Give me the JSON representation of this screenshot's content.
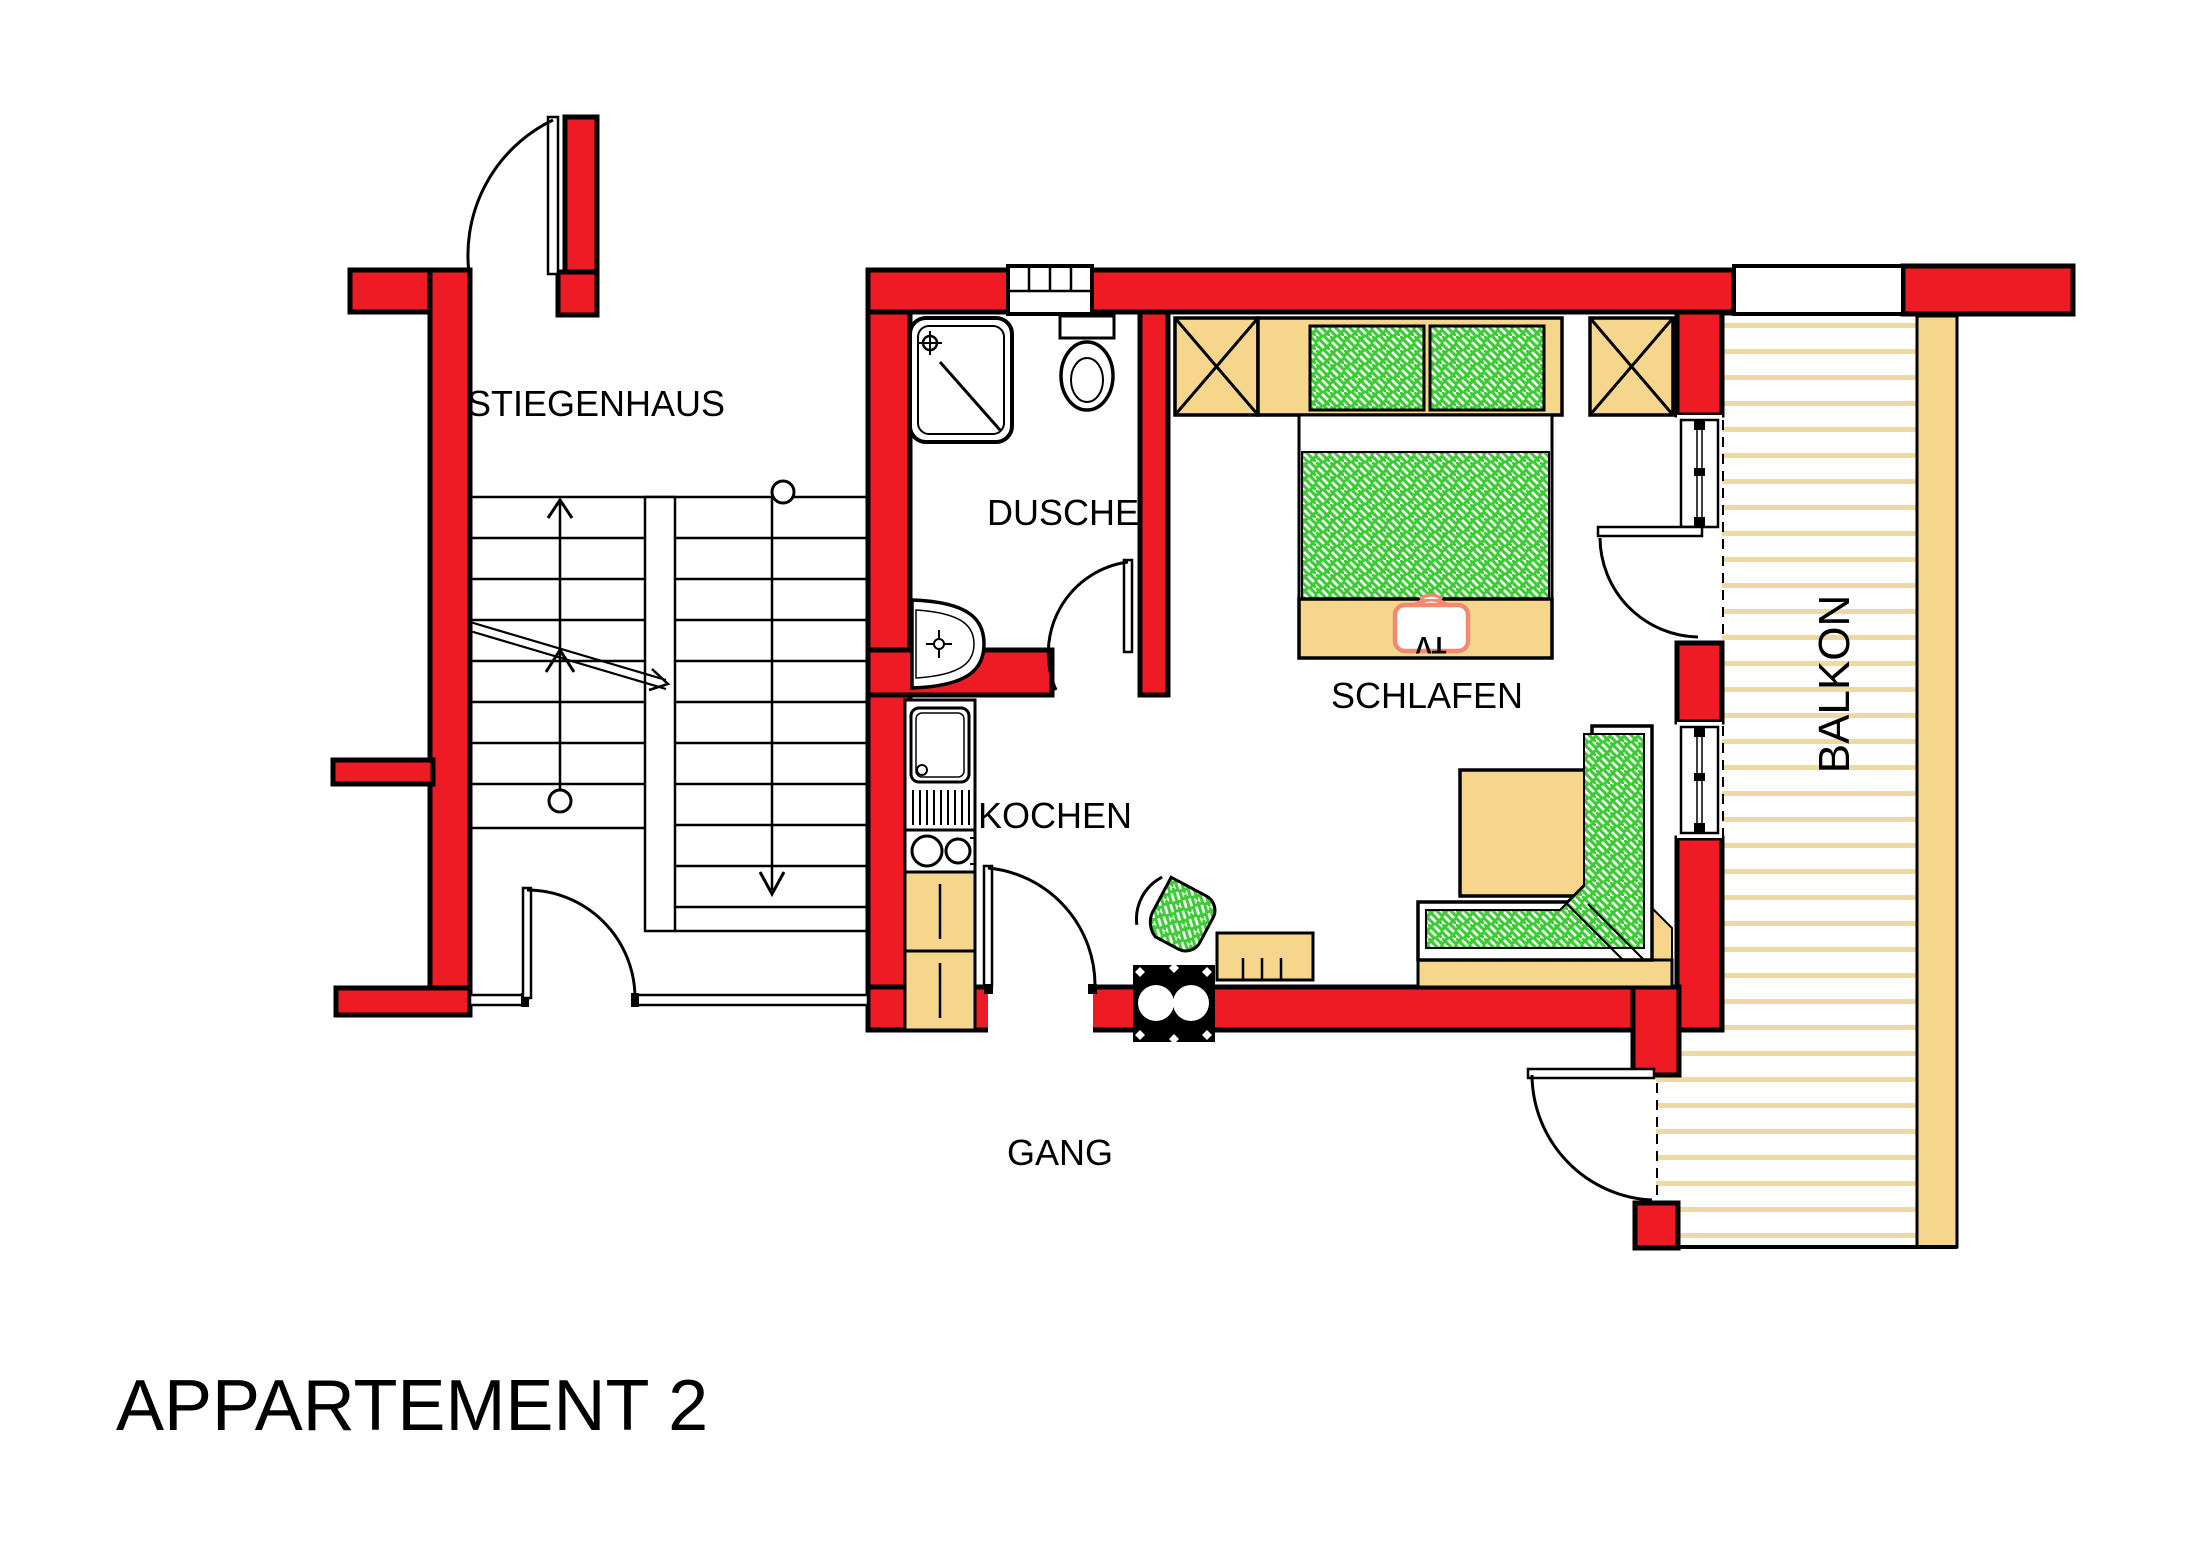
{
  "title": "APPARTEMENT 2",
  "rooms": {
    "stiegenhaus": {
      "label": "STIEGENHAUS"
    },
    "dusche": {
      "label": "DUSCHE"
    },
    "kochen": {
      "label": "KOCHEN"
    },
    "schlafen": {
      "label": "SCHLAFEN"
    },
    "gang": {
      "label": "GANG"
    },
    "balkon": {
      "label": "BALKON"
    }
  },
  "furniture": {
    "tv_label": "TV"
  },
  "colors": {
    "wall_red": "#EE1B24",
    "furniture_tan": "#F6D68C",
    "deck_stripe": "#EFD9A2",
    "fabric_green": "#3BCB33",
    "tv_salmon": "#F18A73",
    "outline": "#000000"
  }
}
